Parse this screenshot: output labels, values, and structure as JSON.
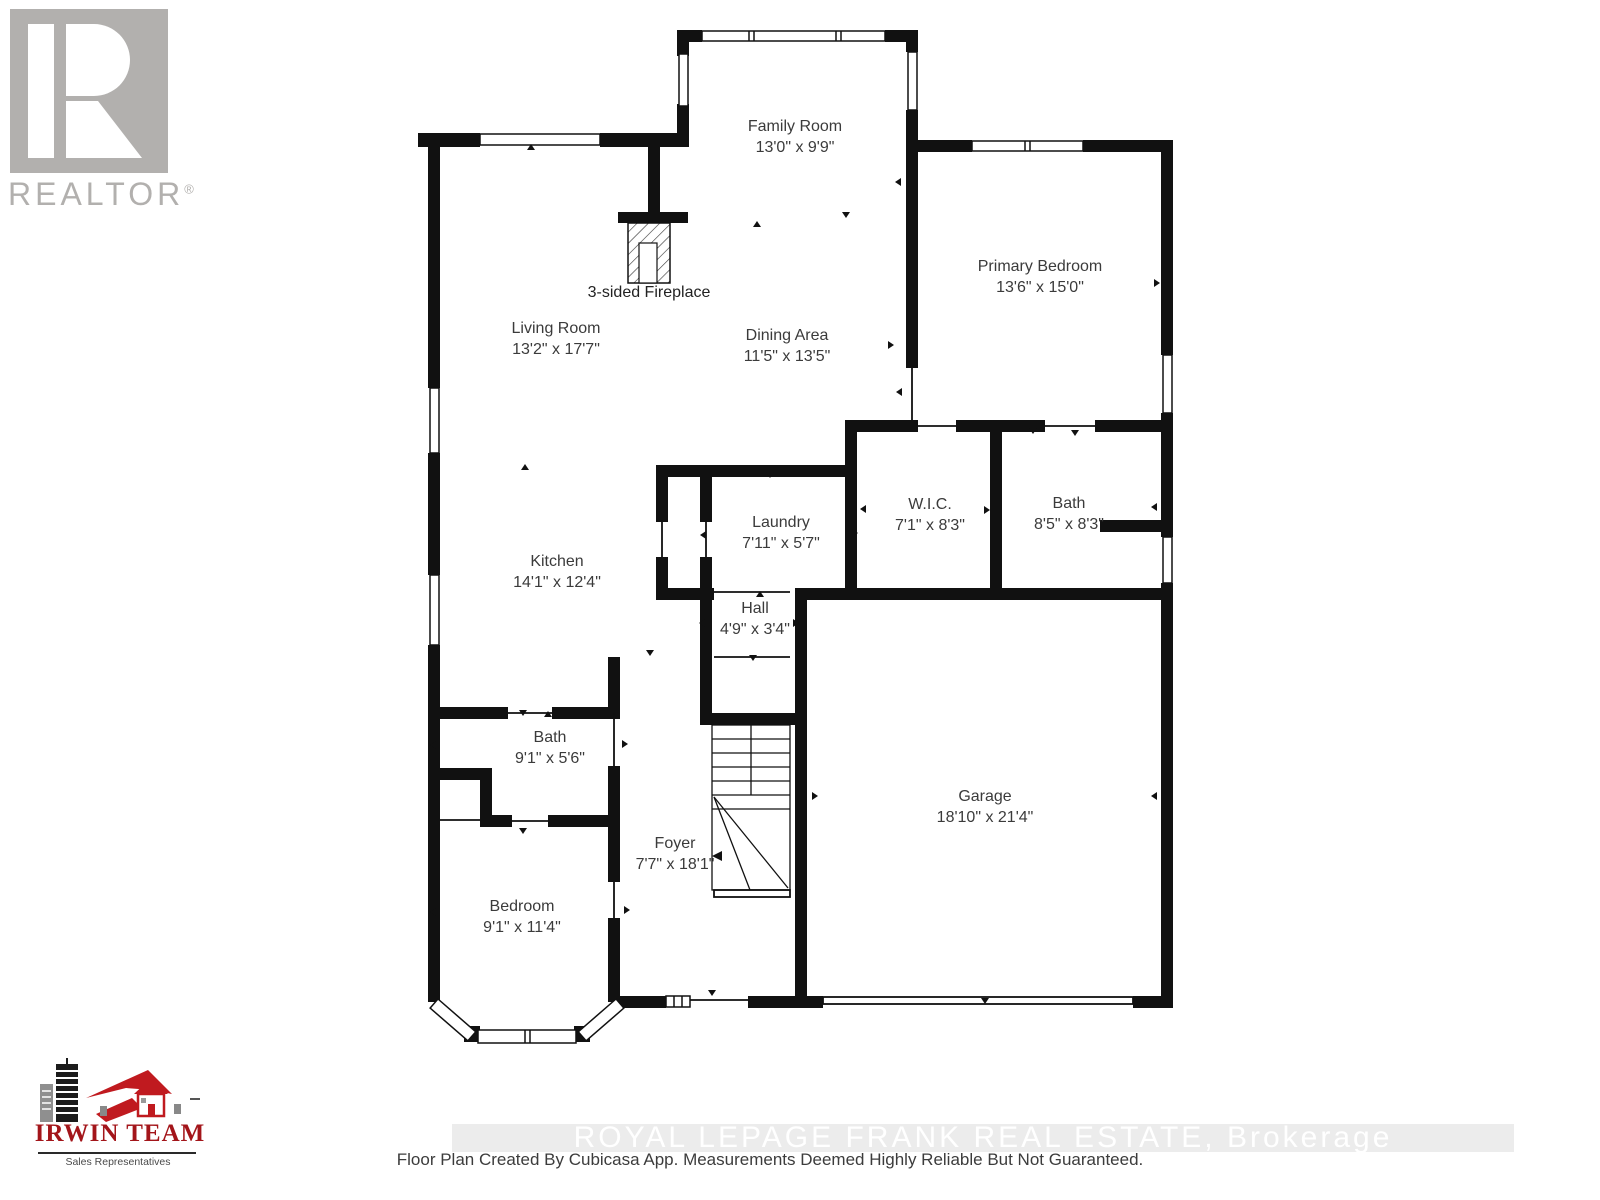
{
  "branding": {
    "realtor": {
      "logo_letter": "R",
      "text": "REALTOR",
      "registered": "®"
    },
    "irwin": {
      "name": "IRWIN TEAM",
      "subtitle": "Sales Representatives"
    },
    "watermark": "ROYAL LEPAGE FRANK REAL ESTATE, Brokerage",
    "disclaimer": "Floor Plan Created By Cubicasa App. Measurements Deemed Highly Reliable But Not Guaranteed."
  },
  "colors": {
    "wall": "#111111",
    "realtor_gray": "#b2b0ae",
    "irwin_red": "#a3151a",
    "label_text": "#3b3b3b"
  },
  "floor_plan": {
    "annotations": {
      "fireplace": "3-sided Fireplace"
    },
    "rooms": [
      {
        "name": "Family Room",
        "dims": "13'0\" x 9'9\""
      },
      {
        "name": "Primary Bedroom",
        "dims": "13'6\" x 15'0\""
      },
      {
        "name": "Living Room",
        "dims": "13'2\" x 17'7\""
      },
      {
        "name": "Dining Area",
        "dims": "11'5\" x 13'5\""
      },
      {
        "name": "Laundry",
        "dims": "7'11\" x 5'7\""
      },
      {
        "name": "W.I.C.",
        "dims": "7'1\" x 8'3\""
      },
      {
        "name": "Bath",
        "dims": "8'5\" x 8'3\""
      },
      {
        "name": "Kitchen",
        "dims": "14'1\" x 12'4\""
      },
      {
        "name": "Hall",
        "dims": "4'9\" x 3'4\""
      },
      {
        "name": "Bath",
        "dims": "9'1\" x 5'6\""
      },
      {
        "name": "Foyer",
        "dims": "7'7\" x 18'1\""
      },
      {
        "name": "Garage",
        "dims": "18'10\" x 21'4\""
      },
      {
        "name": "Bedroom",
        "dims": "9'1\" x 11'4\""
      }
    ]
  }
}
